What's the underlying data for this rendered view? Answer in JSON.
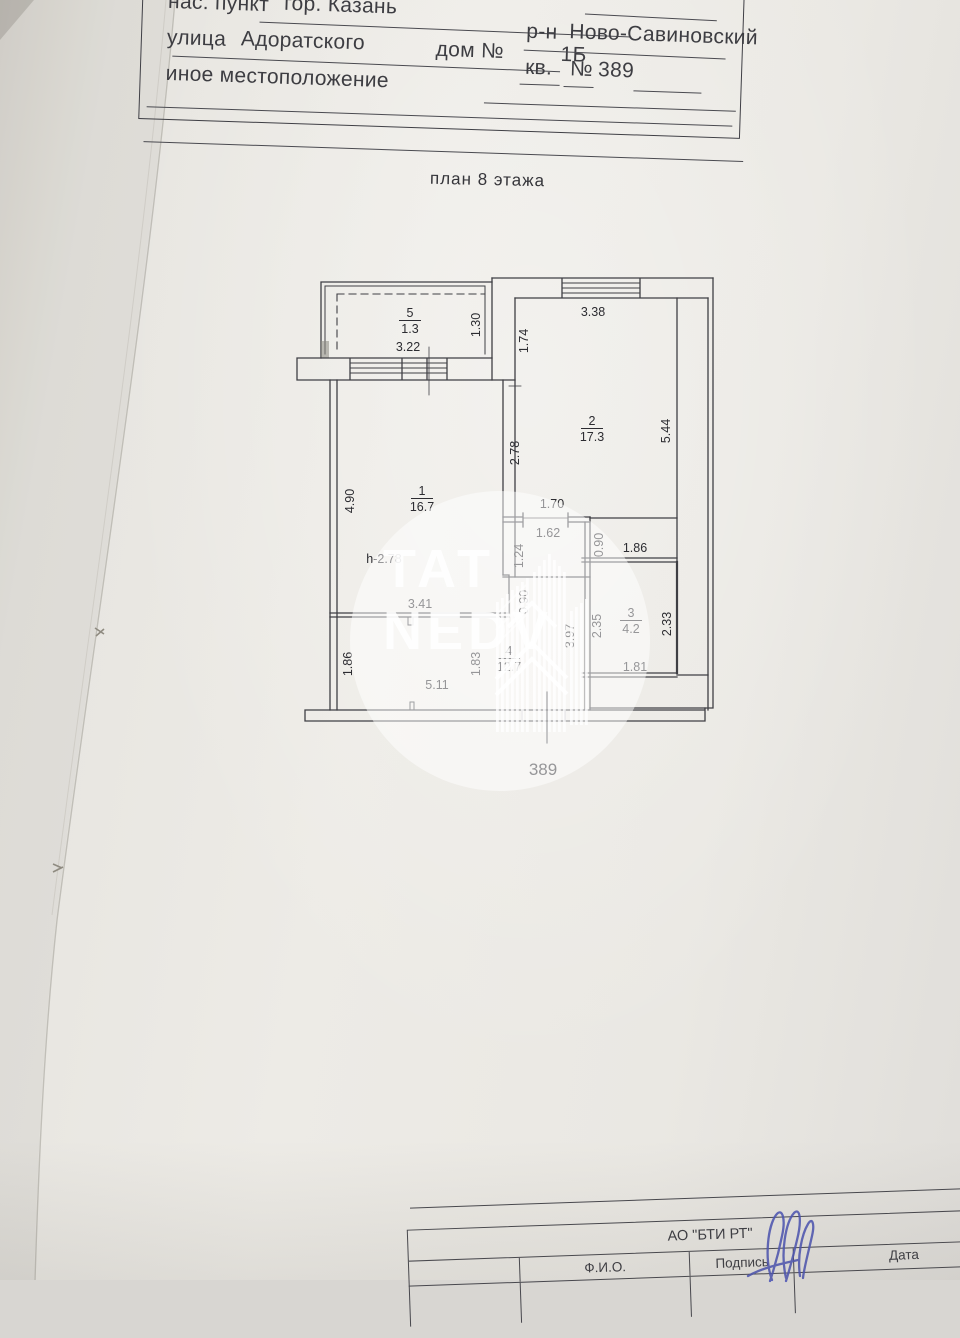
{
  "document": {
    "header": {
      "settlement_label": "нас. пункт",
      "settlement_value": "гор. Казань",
      "street_label": "улица",
      "street_value": "Адоратского",
      "house_label": "дом №",
      "house_value": "1Б",
      "other_location_label": "иное местоположение",
      "district_label": "р-н",
      "district_value": "Ново-Савиновский",
      "apt_label": "кв.",
      "apt_no_sign": "№",
      "apt_value": "389"
    },
    "plan_title": "план 8  этажа",
    "footer": {
      "org_name": "АО \"БТИ РТ\"",
      "columns": [
        "Ф.И.О.",
        "Подпись",
        "Дата"
      ],
      "date_value": "11.05.2022г"
    }
  },
  "plan": {
    "apartment_number_label": "389",
    "rooms": [
      {
        "number": "1",
        "area": "16.7",
        "x": 142,
        "y": 240
      },
      {
        "number": "2",
        "area": "17.3",
        "x": 312,
        "y": 170
      },
      {
        "number": "3",
        "area": "4.2",
        "x": 351,
        "y": 362
      },
      {
        "number": "4",
        "area": "12.7",
        "x": 229,
        "y": 400
      },
      {
        "number": "5",
        "area": "1.3",
        "x": 130,
        "y": 62
      }
    ],
    "dimensions": [
      {
        "t": "3.22",
        "x": 128,
        "y": 96
      },
      {
        "t": "1.30",
        "x": 200,
        "y": 70,
        "r": -90
      },
      {
        "t": "3.38",
        "x": 313,
        "y": 61
      },
      {
        "t": "1.74",
        "x": 248,
        "y": 86,
        "r": -90
      },
      {
        "t": "5.44",
        "x": 390,
        "y": 176,
        "r": -90
      },
      {
        "t": "2.78",
        "x": 239,
        "y": 198,
        "r": -90
      },
      {
        "t": "4.90",
        "x": 74,
        "y": 246,
        "r": -90
      },
      {
        "t": "1.70",
        "x": 272,
        "y": 253
      },
      {
        "t": "1.62",
        "x": 268,
        "y": 282
      },
      {
        "t": "1.24",
        "x": 243,
        "y": 301,
        "r": -90
      },
      {
        "t": "0.90",
        "x": 323,
        "y": 290,
        "r": -90
      },
      {
        "t": "1.86",
        "x": 355,
        "y": 297
      },
      {
        "t": "h-2.78",
        "x": 104,
        "y": 308
      },
      {
        "t": "3.41",
        "x": 140,
        "y": 353
      },
      {
        "t": "0.90",
        "x": 248,
        "y": 347,
        "r": -90
      },
      {
        "t": "2.35",
        "x": 321,
        "y": 371,
        "r": -90
      },
      {
        "t": "2.33",
        "x": 391,
        "y": 369,
        "r": -90
      },
      {
        "t": "3.97",
        "x": 294,
        "y": 381,
        "r": -90
      },
      {
        "t": "1.86",
        "x": 72,
        "y": 409,
        "r": -90
      },
      {
        "t": "1.83",
        "x": 200,
        "y": 409,
        "r": -90
      },
      {
        "t": "5.11",
        "x": 157,
        "y": 434
      },
      {
        "t": "1.81",
        "x": 355,
        "y": 416
      }
    ]
  },
  "watermark": {
    "line1": "TAT",
    "line2": "NEDV"
  },
  "colors": {
    "ink": "#3f3f44",
    "paper": "#eae8e3",
    "signature_blue": "#4d55b5"
  }
}
